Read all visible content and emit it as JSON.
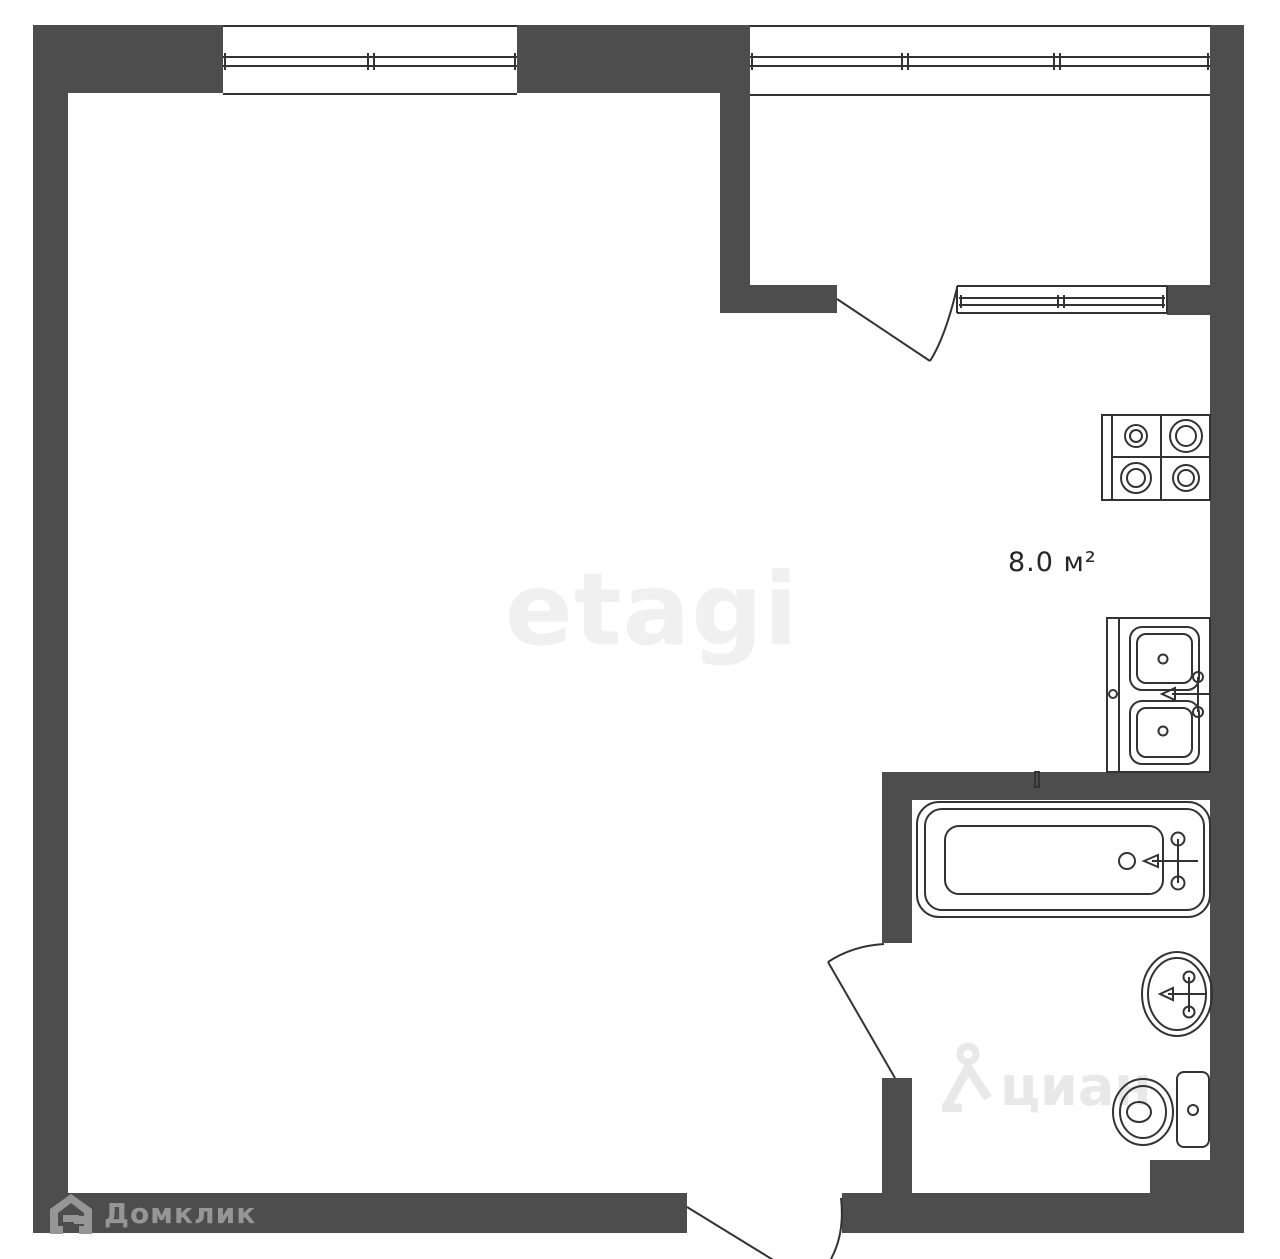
{
  "labels": {
    "kitchen_area": "8.0 м²"
  },
  "watermarks": {
    "etagi": "etagi",
    "domclick": "Домклик",
    "cian": "циан"
  },
  "colors": {
    "wall": "#4d4d4d",
    "plan_line": "#333333",
    "fixture_line": "#2e2e2e",
    "background": "#ffffff",
    "kitchen_label": "#262626",
    "etagi_watermark": "#f0f0f0",
    "cian_watermark": "#e8e8e8",
    "domclick_logo": "#969696"
  },
  "icons": [
    "stove-icon",
    "kitchen-sink-icon",
    "bathtub-icon",
    "washbasin-icon",
    "toilet-icon",
    "domclick-house-icon",
    "cian-person-house-icon"
  ]
}
